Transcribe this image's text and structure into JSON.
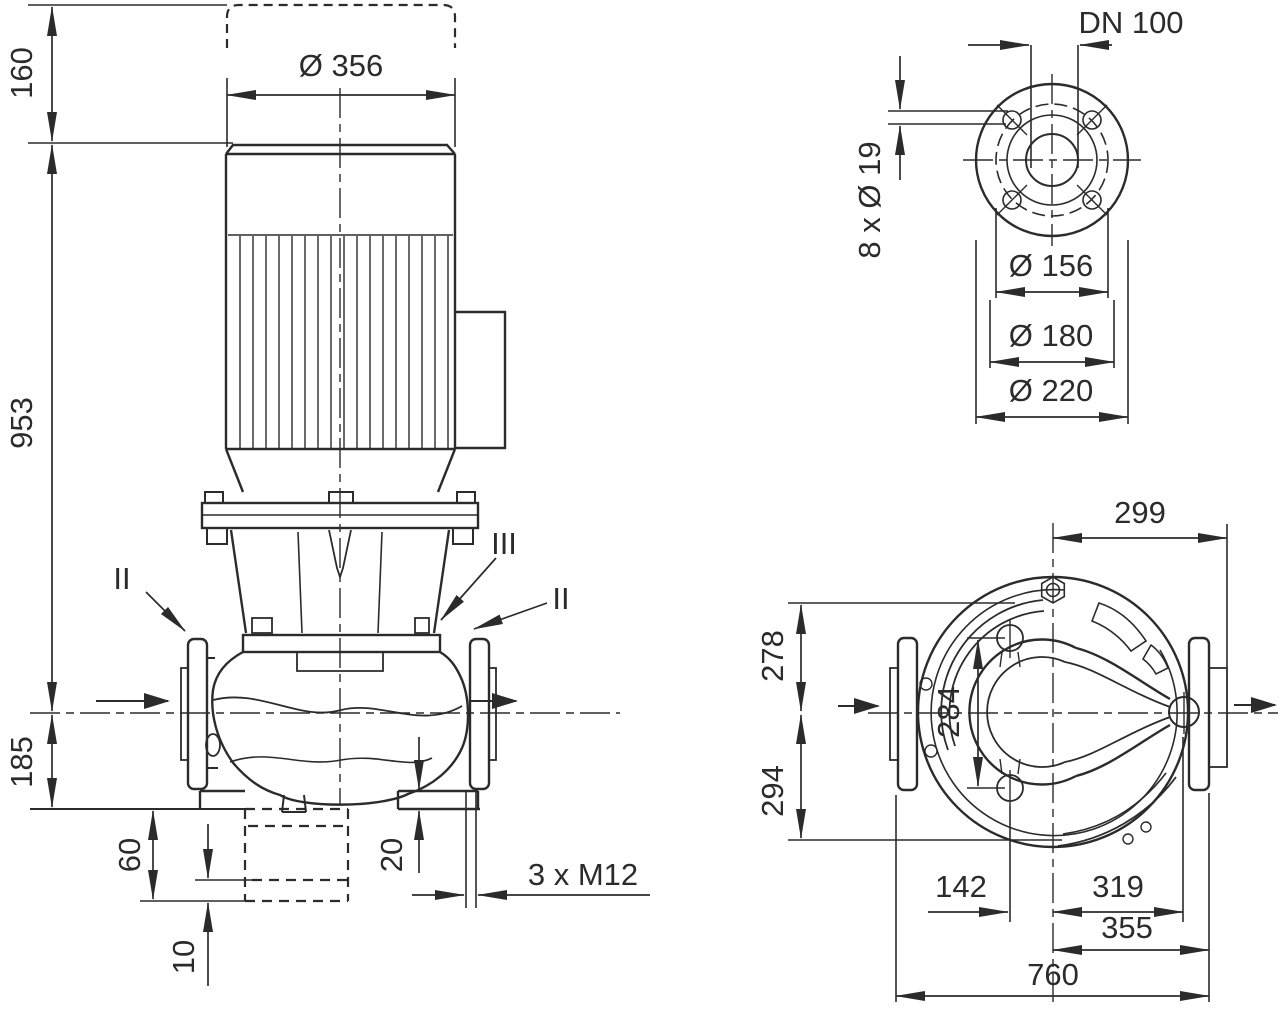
{
  "drawing_type": "pump dimensional drawing",
  "colors": {
    "ink": "#2b2b2b",
    "background": "#ffffff"
  },
  "side_view": {
    "fan_clearance": "160",
    "overall_height": "953",
    "axis_to_foot": "185",
    "motor_diameter": "Ø 356",
    "foot_to_anchor": "60",
    "grout_thickness": "10",
    "foot_plate_thickness": "20",
    "anchor_thread": "3 x M12",
    "section_left": "II",
    "section_center": "III",
    "section_right": "II"
  },
  "flange_view": {
    "nominal_diameter": "DN 100",
    "bolt_holes": "8 x Ø 19",
    "pilot_diameter": "Ø 156",
    "bolt_circle": "Ø 180",
    "flange_outer": "Ø 220"
  },
  "plan_view": {
    "center_to_flange_face_right": "299",
    "axis_to_top_edge": "278",
    "axis_to_bottom_edge": "294",
    "foot_bolt_spacing": "284",
    "foot_bolt_offset": "142",
    "center_to_discharge_end": "319",
    "center_to_flange_right": "355",
    "overall_length": "760"
  }
}
